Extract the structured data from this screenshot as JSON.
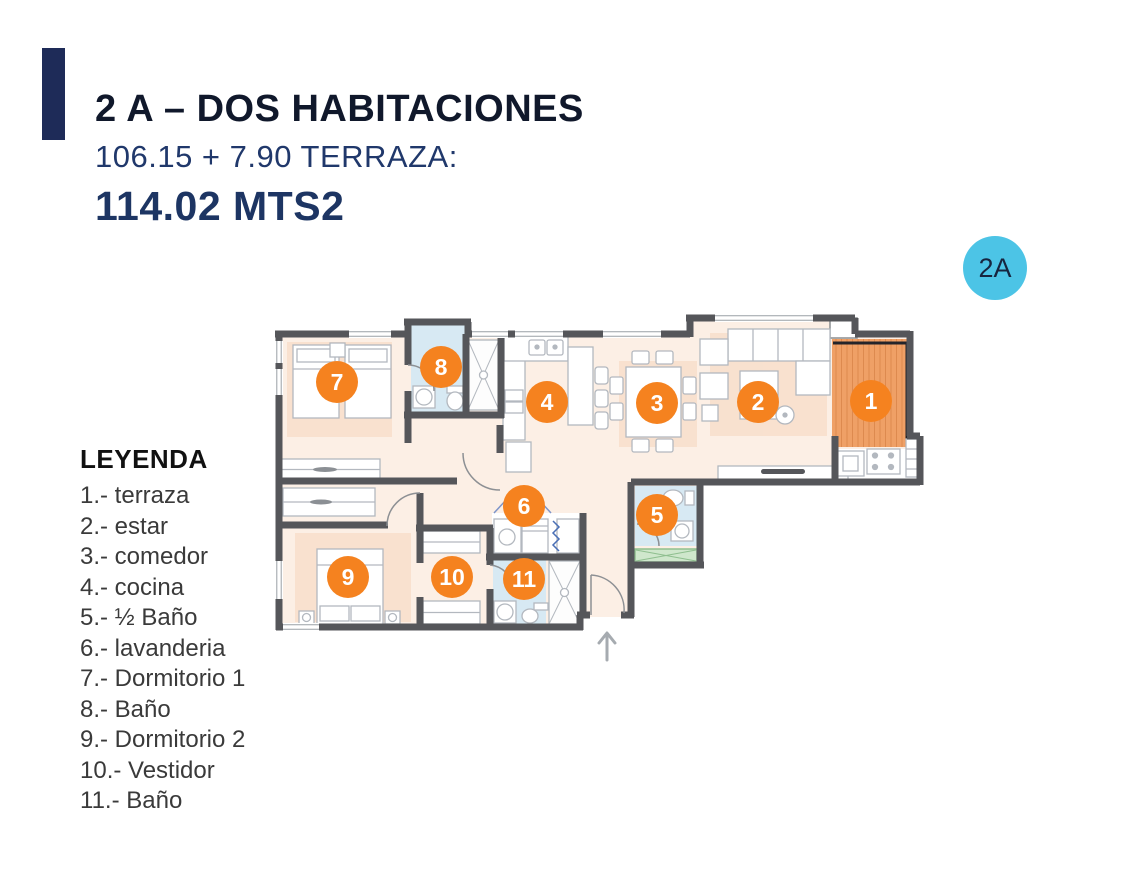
{
  "header": {
    "title": "2 A – DOS HABITACIONES",
    "subtitle": "106.15 + 7.90 TERRAZA:",
    "area": "114.02 MTS2",
    "accent_color": "#1e2b58",
    "navy_color": "#20386b"
  },
  "unit_badge": {
    "label": "2A",
    "background": "#4cc4e6",
    "text_color": "#17253f"
  },
  "legend": {
    "heading": "LEYENDA",
    "items": [
      "1.- terraza",
      "2.- estar",
      "3.- comedor",
      "4.- cocina",
      "5.- ½ Baño",
      "6.- lavanderia",
      "7.- Dormitorio 1",
      "8.- Baño",
      "9.- Dormitorio 2",
      "10.- Vestidor",
      "11.- Baño"
    ]
  },
  "floor_plan": {
    "marker_color": "#f5821f",
    "marker_text_color": "#ffffff",
    "wall_color": "#55565a",
    "floor_color": "#fcefe5",
    "furniture_zone_color": "#f7d9c2",
    "bathroom_floor_color": "#d7e9f3",
    "terrace_color": "#efa066",
    "closet_green_color": "#cfe7cc",
    "entrance_arrow_direction": "up",
    "markers": [
      {
        "n": "1",
        "x": 608,
        "y": 98
      },
      {
        "n": "2",
        "x": 495,
        "y": 99
      },
      {
        "n": "3",
        "x": 394,
        "y": 100
      },
      {
        "n": "4",
        "x": 284,
        "y": 99
      },
      {
        "n": "5",
        "x": 394,
        "y": 212
      },
      {
        "n": "6",
        "x": 261,
        "y": 203
      },
      {
        "n": "7",
        "x": 74,
        "y": 79
      },
      {
        "n": "8",
        "x": 178,
        "y": 64
      },
      {
        "n": "9",
        "x": 85,
        "y": 274
      },
      {
        "n": "10",
        "x": 189,
        "y": 274
      },
      {
        "n": "11",
        "x": 261,
        "y": 276
      }
    ]
  }
}
